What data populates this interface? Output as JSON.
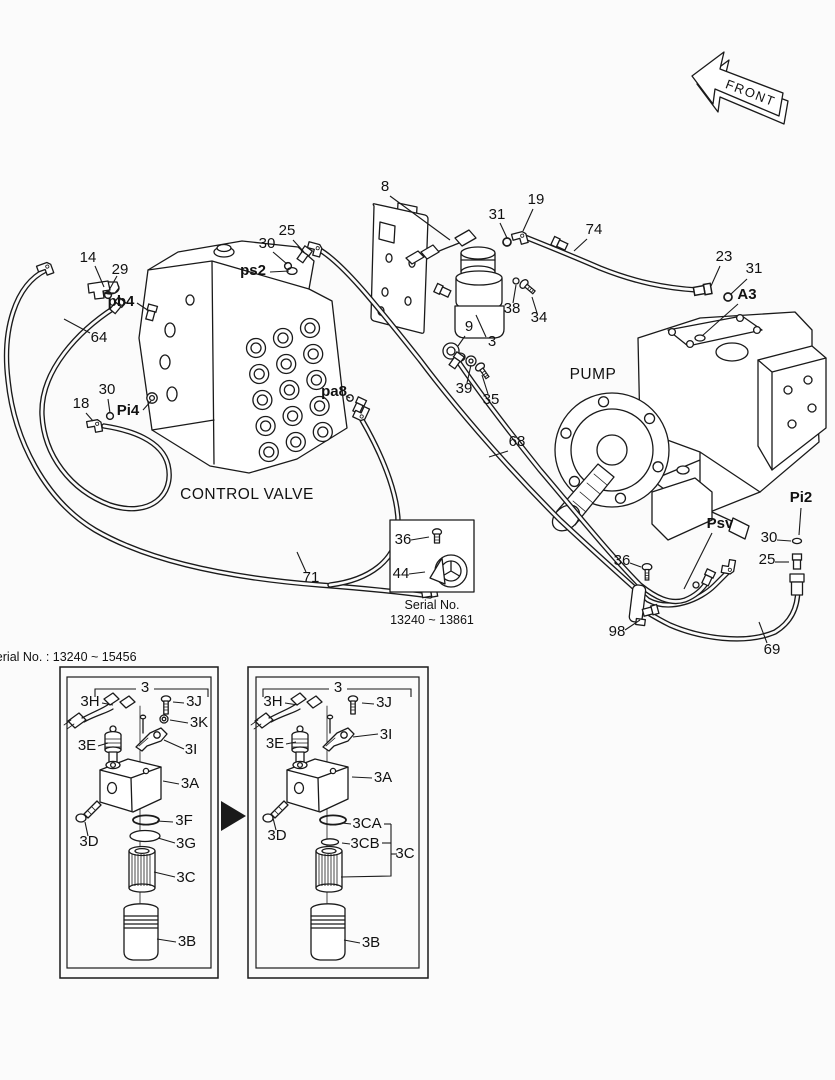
{
  "meta": {
    "title": "hydraulic piping parts diagram",
    "ink_color": "#1a1a1a",
    "bg_color": "#fbfbfb"
  },
  "front_marker": {
    "label": "FRONT"
  },
  "labels": [
    {
      "n": "area-control-valve",
      "t": "CONTROL VALVE",
      "x": 247,
      "y": 499,
      "s": "big"
    },
    {
      "n": "area-pump",
      "t": "PUMP",
      "x": 593,
      "y": 379,
      "s": "big"
    },
    {
      "n": "callout-14",
      "t": "14",
      "x": 88,
      "y": 262,
      "lead": [
        [
          [
            95,
            266
          ],
          [
            104,
            287
          ]
        ]
      ]
    },
    {
      "n": "callout-29",
      "t": "29",
      "x": 120,
      "y": 274,
      "lead": [
        [
          [
            117,
            276
          ],
          [
            108,
            292
          ]
        ]
      ]
    },
    {
      "n": "port-pb4",
      "t": "pb4",
      "x": 121,
      "y": 306,
      "b": 1,
      "lead": [
        [
          [
            137,
            303
          ],
          [
            149,
            311
          ]
        ]
      ]
    },
    {
      "n": "callout-64",
      "t": "64",
      "x": 99,
      "y": 342,
      "lead": [
        [
          [
            90,
            333
          ],
          [
            64,
            319
          ]
        ]
      ]
    },
    {
      "n": "callout-30-a",
      "t": "30",
      "x": 267,
      "y": 248,
      "lead": [
        [
          [
            273,
            252
          ],
          [
            287,
            264
          ]
        ]
      ]
    },
    {
      "n": "callout-25-a",
      "t": "25",
      "x": 287,
      "y": 235,
      "lead": [
        [
          [
            293,
            240
          ],
          [
            304,
            252
          ]
        ]
      ]
    },
    {
      "n": "port-ps2",
      "t": "ps2",
      "x": 253,
      "y": 275,
      "b": 1,
      "lead": [
        [
          [
            270,
            272
          ],
          [
            289,
            271
          ]
        ]
      ]
    },
    {
      "n": "callout-8",
      "t": "8",
      "x": 385,
      "y": 191,
      "lead": [
        [
          [
            390,
            196
          ],
          [
            450,
            240
          ]
        ]
      ]
    },
    {
      "n": "callout-31-a",
      "t": "31",
      "x": 497,
      "y": 219,
      "lead": [
        [
          [
            500,
            223
          ],
          [
            507,
            238
          ]
        ]
      ]
    },
    {
      "n": "callout-19",
      "t": "19",
      "x": 536,
      "y": 204,
      "lead": [
        [
          [
            533,
            209
          ],
          [
            523,
            231
          ]
        ]
      ]
    },
    {
      "n": "callout-74",
      "t": "74",
      "x": 594,
      "y": 234,
      "lead": [
        [
          [
            587,
            239
          ],
          [
            574,
            251
          ]
        ]
      ]
    },
    {
      "n": "callout-23",
      "t": "23",
      "x": 724,
      "y": 261,
      "lead": [
        [
          [
            720,
            266
          ],
          [
            711,
            286
          ]
        ]
      ]
    },
    {
      "n": "callout-31-b",
      "t": "31",
      "x": 754,
      "y": 273,
      "lead": [
        [
          [
            747,
            279
          ],
          [
            731,
            294
          ]
        ]
      ]
    },
    {
      "n": "port-a3",
      "t": "A3",
      "x": 747,
      "y": 299,
      "b": 1,
      "lead": [
        [
          [
            738,
            304
          ],
          [
            702,
            336
          ]
        ]
      ]
    },
    {
      "n": "callout-38",
      "t": "38",
      "x": 512,
      "y": 313,
      "lead": [
        [
          [
            513,
            303
          ],
          [
            516,
            285
          ]
        ]
      ]
    },
    {
      "n": "callout-34",
      "t": "34",
      "x": 539,
      "y": 322,
      "lead": [
        [
          [
            537,
            313
          ],
          [
            532,
            297
          ]
        ]
      ]
    },
    {
      "n": "callout-9",
      "t": "9",
      "x": 469,
      "y": 331,
      "lead": [
        [
          [
            465,
            336
          ],
          [
            458,
            346
          ]
        ]
      ]
    },
    {
      "n": "callout-3",
      "t": "3",
      "x": 492,
      "y": 346,
      "lead": [
        [
          [
            486,
            337
          ],
          [
            476,
            315
          ]
        ]
      ]
    },
    {
      "n": "callout-39",
      "t": "39",
      "x": 464,
      "y": 393,
      "lead": [
        [
          [
            467,
            383
          ],
          [
            471,
            365
          ]
        ]
      ]
    },
    {
      "n": "callout-35",
      "t": "35",
      "x": 491,
      "y": 404,
      "lead": [
        [
          [
            488,
            394
          ],
          [
            482,
            375
          ]
        ]
      ]
    },
    {
      "n": "callout-18",
      "t": "18",
      "x": 81,
      "y": 408,
      "lead": [
        [
          [
            86,
            413
          ],
          [
            93,
            421
          ]
        ]
      ]
    },
    {
      "n": "callout-30-b",
      "t": "30",
      "x": 107,
      "y": 394,
      "lead": [
        [
          [
            108,
            399
          ],
          [
            110,
            413
          ]
        ]
      ]
    },
    {
      "n": "port-pi4",
      "t": "Pi4",
      "x": 128,
      "y": 415,
      "b": 1,
      "lead": [
        [
          [
            143,
            410
          ],
          [
            151,
            401
          ]
        ]
      ]
    },
    {
      "n": "port-pa8",
      "t": "pa8",
      "x": 334,
      "y": 396,
      "b": 1,
      "lead": [
        [
          [
            346,
            396
          ],
          [
            350,
            398
          ]
        ]
      ]
    },
    {
      "n": "callout-68",
      "t": "68",
      "x": 517,
      "y": 446,
      "lead": [
        [
          [
            508,
            451
          ],
          [
            489,
            457
          ]
        ]
      ]
    },
    {
      "n": "callout-71",
      "t": "71",
      "x": 311,
      "y": 582,
      "lead": [
        [
          [
            306,
            572
          ],
          [
            297,
            552
          ]
        ]
      ]
    },
    {
      "n": "port-pi2",
      "t": "Pi2",
      "x": 801,
      "y": 502,
      "b": 1,
      "lead": [
        [
          [
            801,
            508
          ],
          [
            799,
            535
          ]
        ]
      ]
    },
    {
      "n": "port-psv",
      "t": "Psv",
      "x": 720,
      "y": 528,
      "b": 1,
      "lead": [
        [
          [
            712,
            533
          ],
          [
            684,
            589
          ]
        ]
      ]
    },
    {
      "n": "callout-30-c",
      "t": "30",
      "x": 769,
      "y": 542,
      "lead": [
        [
          [
            777,
            540
          ],
          [
            791,
            541
          ]
        ]
      ]
    },
    {
      "n": "callout-25-b",
      "t": "25",
      "x": 767,
      "y": 564,
      "lead": [
        [
          [
            775,
            562
          ],
          [
            789,
            562
          ]
        ]
      ]
    },
    {
      "n": "callout-36-a",
      "t": "36",
      "x": 622,
      "y": 565,
      "lead": [
        [
          [
            630,
            563
          ],
          [
            641,
            567
          ]
        ]
      ]
    },
    {
      "n": "callout-98",
      "t": "98",
      "x": 617,
      "y": 636,
      "lead": [
        [
          [
            625,
            630
          ],
          [
            640,
            620
          ]
        ]
      ]
    },
    {
      "n": "callout-69",
      "t": "69",
      "x": 772,
      "y": 654,
      "lead": [
        [
          [
            767,
            643
          ],
          [
            759,
            622
          ]
        ]
      ]
    },
    {
      "n": "callout-36-b",
      "t": "36",
      "x": 403,
      "y": 544,
      "lead": [
        [
          [
            411,
            540
          ],
          [
            429,
            537
          ]
        ]
      ]
    },
    {
      "n": "callout-44",
      "t": "44",
      "x": 401,
      "y": 578,
      "lead": [
        [
          [
            409,
            574
          ],
          [
            425,
            572
          ]
        ]
      ]
    },
    {
      "n": "inset-caption-line1",
      "t": "Serial No.",
      "x": 432,
      "y": 609,
      "s": "small"
    },
    {
      "n": "inset-caption-line2",
      "t": "13240 ~ 13861",
      "x": 432,
      "y": 624,
      "s": "small"
    },
    {
      "n": "serial-range-left",
      "t": "Serial No. : 13240 ~ 15456",
      "x": 62,
      "y": 661,
      "s": "small",
      "a": "start"
    },
    {
      "n": "group-3-left",
      "t": "3",
      "x": 145,
      "y": 692,
      "lead": [
        [
          [
            95,
            697
          ],
          [
            95,
            689
          ],
          [
            136,
            689
          ]
        ],
        [
          [
            154,
            689
          ],
          [
            208,
            689
          ],
          [
            208,
            697
          ]
        ]
      ]
    },
    {
      "n": "callout-3h-left",
      "t": "3H",
      "x": 90,
      "y": 706,
      "lead": [
        [
          [
            102,
            703
          ],
          [
            113,
            705
          ]
        ]
      ]
    },
    {
      "n": "callout-3j-left",
      "t": "3J",
      "x": 194,
      "y": 706,
      "lead": [
        [
          [
            184,
            703
          ],
          [
            173,
            702
          ]
        ]
      ]
    },
    {
      "n": "callout-3k-left",
      "t": "3K",
      "x": 199,
      "y": 727,
      "lead": [
        [
          [
            188,
            723
          ],
          [
            170,
            720
          ]
        ]
      ]
    },
    {
      "n": "callout-3e-left",
      "t": "3E",
      "x": 87,
      "y": 750,
      "lead": [
        [
          [
            98,
            746
          ],
          [
            108,
            743
          ]
        ]
      ]
    },
    {
      "n": "callout-3i-left",
      "t": "3I",
      "x": 191,
      "y": 754,
      "lead": [
        [
          [
            184,
            749
          ],
          [
            164,
            740
          ]
        ]
      ]
    },
    {
      "n": "callout-3a-left",
      "t": "3A",
      "x": 190,
      "y": 788,
      "lead": [
        [
          [
            179,
            784
          ],
          [
            163,
            781
          ]
        ]
      ]
    },
    {
      "n": "callout-3d-left",
      "t": "3D",
      "x": 89,
      "y": 846,
      "lead": [
        [
          [
            88,
            836
          ],
          [
            85,
            822
          ]
        ]
      ]
    },
    {
      "n": "callout-3f-left",
      "t": "3F",
      "x": 184,
      "y": 825,
      "lead": [
        [
          [
            173,
            822
          ],
          [
            157,
            821
          ]
        ]
      ]
    },
    {
      "n": "callout-3g-left",
      "t": "3G",
      "x": 186,
      "y": 848,
      "lead": [
        [
          [
            175,
            843
          ],
          [
            158,
            838
          ]
        ]
      ]
    },
    {
      "n": "callout-3c-left",
      "t": "3C",
      "x": 186,
      "y": 882,
      "lead": [
        [
          [
            175,
            877
          ],
          [
            154,
            872
          ]
        ]
      ]
    },
    {
      "n": "callout-3b-left",
      "t": "3B",
      "x": 187,
      "y": 946,
      "lead": [
        [
          [
            176,
            942
          ],
          [
            157,
            939
          ]
        ]
      ]
    },
    {
      "n": "group-3-right",
      "t": "3",
      "x": 338,
      "y": 692,
      "lead": [
        [
          [
            263,
            697
          ],
          [
            263,
            689
          ],
          [
            329,
            689
          ]
        ],
        [
          [
            347,
            689
          ],
          [
            411,
            689
          ],
          [
            411,
            697
          ]
        ]
      ]
    },
    {
      "n": "callout-3h-right",
      "t": "3H",
      "x": 273,
      "y": 706,
      "lead": [
        [
          [
            285,
            703
          ],
          [
            298,
            705
          ]
        ]
      ]
    },
    {
      "n": "callout-3j-right",
      "t": "3J",
      "x": 384,
      "y": 707,
      "lead": [
        [
          [
            374,
            704
          ],
          [
            362,
            703
          ]
        ]
      ]
    },
    {
      "n": "callout-3e-right",
      "t": "3E",
      "x": 275,
      "y": 748,
      "lead": [
        [
          [
            286,
            744
          ],
          [
            296,
            742
          ]
        ]
      ]
    },
    {
      "n": "callout-3i-right",
      "t": "3I",
      "x": 386,
      "y": 739,
      "lead": [
        [
          [
            378,
            734
          ],
          [
            353,
            737
          ]
        ]
      ]
    },
    {
      "n": "callout-3a-right",
      "t": "3A",
      "x": 383,
      "y": 782,
      "lead": [
        [
          [
            372,
            778
          ],
          [
            352,
            777
          ]
        ]
      ]
    },
    {
      "n": "callout-3d-right",
      "t": "3D",
      "x": 277,
      "y": 840,
      "lead": [
        [
          [
            276,
            830
          ],
          [
            273,
            818
          ]
        ]
      ]
    },
    {
      "n": "callout-3ca-right",
      "t": "3CA",
      "x": 367,
      "y": 828,
      "lead": [
        [
          [
            351,
            824
          ],
          [
            342,
            823
          ]
        ],
        [
          [
            384,
            824
          ],
          [
            391,
            824
          ]
        ]
      ]
    },
    {
      "n": "callout-3cb-right",
      "t": "3CB",
      "x": 365,
      "y": 848,
      "lead": [
        [
          [
            350,
            844
          ],
          [
            342,
            843
          ]
        ],
        [
          [
            382,
            843
          ],
          [
            391,
            843
          ]
        ]
      ]
    },
    {
      "n": "callout-3c-right",
      "t": "3C",
      "x": 405,
      "y": 858,
      "lead": [
        [
          [
            391,
            824
          ],
          [
            391,
            876
          ],
          [
            341,
            877
          ]
        ],
        [
          [
            397,
            854
          ],
          [
            391,
            854
          ]
        ]
      ]
    },
    {
      "n": "callout-3b-right",
      "t": "3B",
      "x": 371,
      "y": 947,
      "lead": [
        [
          [
            360,
            943
          ],
          [
            344,
            940
          ]
        ]
      ]
    }
  ]
}
